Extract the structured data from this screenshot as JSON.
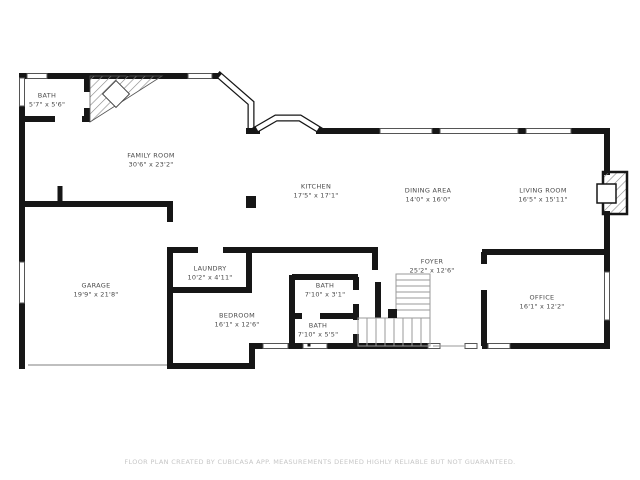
{
  "floor_plan": {
    "rooms": [
      {
        "name": "BATH",
        "dims": "5'7\" x 5'6\""
      },
      {
        "name": "FAMILY ROOM",
        "dims": "30'6\" x 23'2\""
      },
      {
        "name": "KITCHEN",
        "dims": "17'5\" x 17'1\""
      },
      {
        "name": "DINING AREA",
        "dims": "14'0\" x 16'0\""
      },
      {
        "name": "LIVING ROOM",
        "dims": "16'5\" x 15'11\""
      },
      {
        "name": "GARAGE",
        "dims": "19'9\" x 21'8\""
      },
      {
        "name": "LAUNDRY",
        "dims": "10'2\" x 4'11\""
      },
      {
        "name": "BEDROOM",
        "dims": "16'1\" x 12'6\""
      },
      {
        "name": "BATH",
        "dims": "7'10\" x 3'1\""
      },
      {
        "name": "BATH",
        "dims": "7'10\" x 5'5\""
      },
      {
        "name": "FOYER",
        "dims": "25'2\" x 12'6\""
      },
      {
        "name": "OFFICE",
        "dims": "16'1\" x 12'2\""
      }
    ],
    "footer": "FLOOR PLAN CREATED BY CUBICASA APP. MEASUREMENTS DEEMED HIGHLY RELIABLE BUT NOT GUARANTEED.",
    "colors": {
      "wall": "#161616",
      "label_text": "#4a4a4a",
      "footer_text": "#c6c6c6",
      "stair_line": "#9a9a9a",
      "background": "#ffffff"
    }
  }
}
